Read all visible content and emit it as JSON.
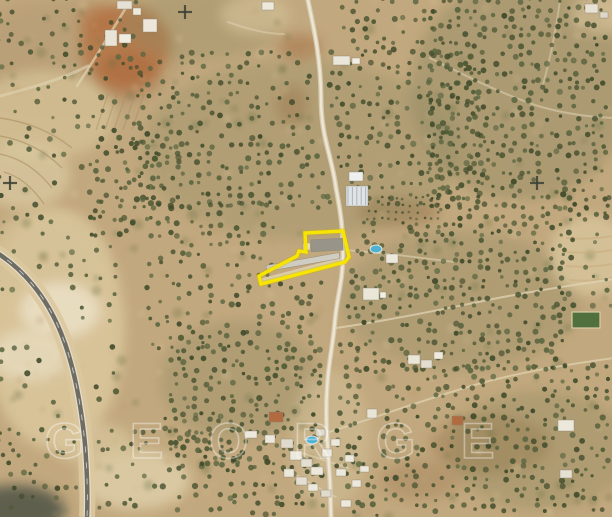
{
  "image": {
    "width": 612,
    "height": 517,
    "kind": "aerial-satellite-photo",
    "watermark": {
      "text": "GEORGE",
      "color": "#ffffff",
      "opacity": 0.38
    },
    "parcel": {
      "points": [
        [
          305,
          233
        ],
        [
          343,
          231
        ],
        [
          349,
          257
        ],
        [
          345,
          262
        ],
        [
          261,
          284
        ],
        [
          259,
          276
        ],
        [
          297,
          256
        ],
        [
          299,
          251
        ],
        [
          306,
          252
        ]
      ],
      "stroke": "#f7e400",
      "stroke_width": 3.4,
      "halo": "#c9b400"
    },
    "survey_crosses": [
      {
        "x": 10,
        "y": 183
      },
      {
        "x": 185,
        "y": 12
      },
      {
        "x": 537,
        "y": 183
      }
    ],
    "pools": [
      {
        "x": 376,
        "y": 249
      },
      {
        "x": 312,
        "y": 440
      }
    ],
    "palette": {
      "terrain_base": "#c2a87e",
      "olive_tree": "#4d5731",
      "road_asphalt": "#6e6d64",
      "road_shoulder": "#dcc89e",
      "building_white": "#ece8dc",
      "roof_orange": "#b26b40",
      "pool_blue": "#4fb2d4",
      "soil_red": "#b4703f",
      "cross_dark": "#3c4134"
    }
  }
}
